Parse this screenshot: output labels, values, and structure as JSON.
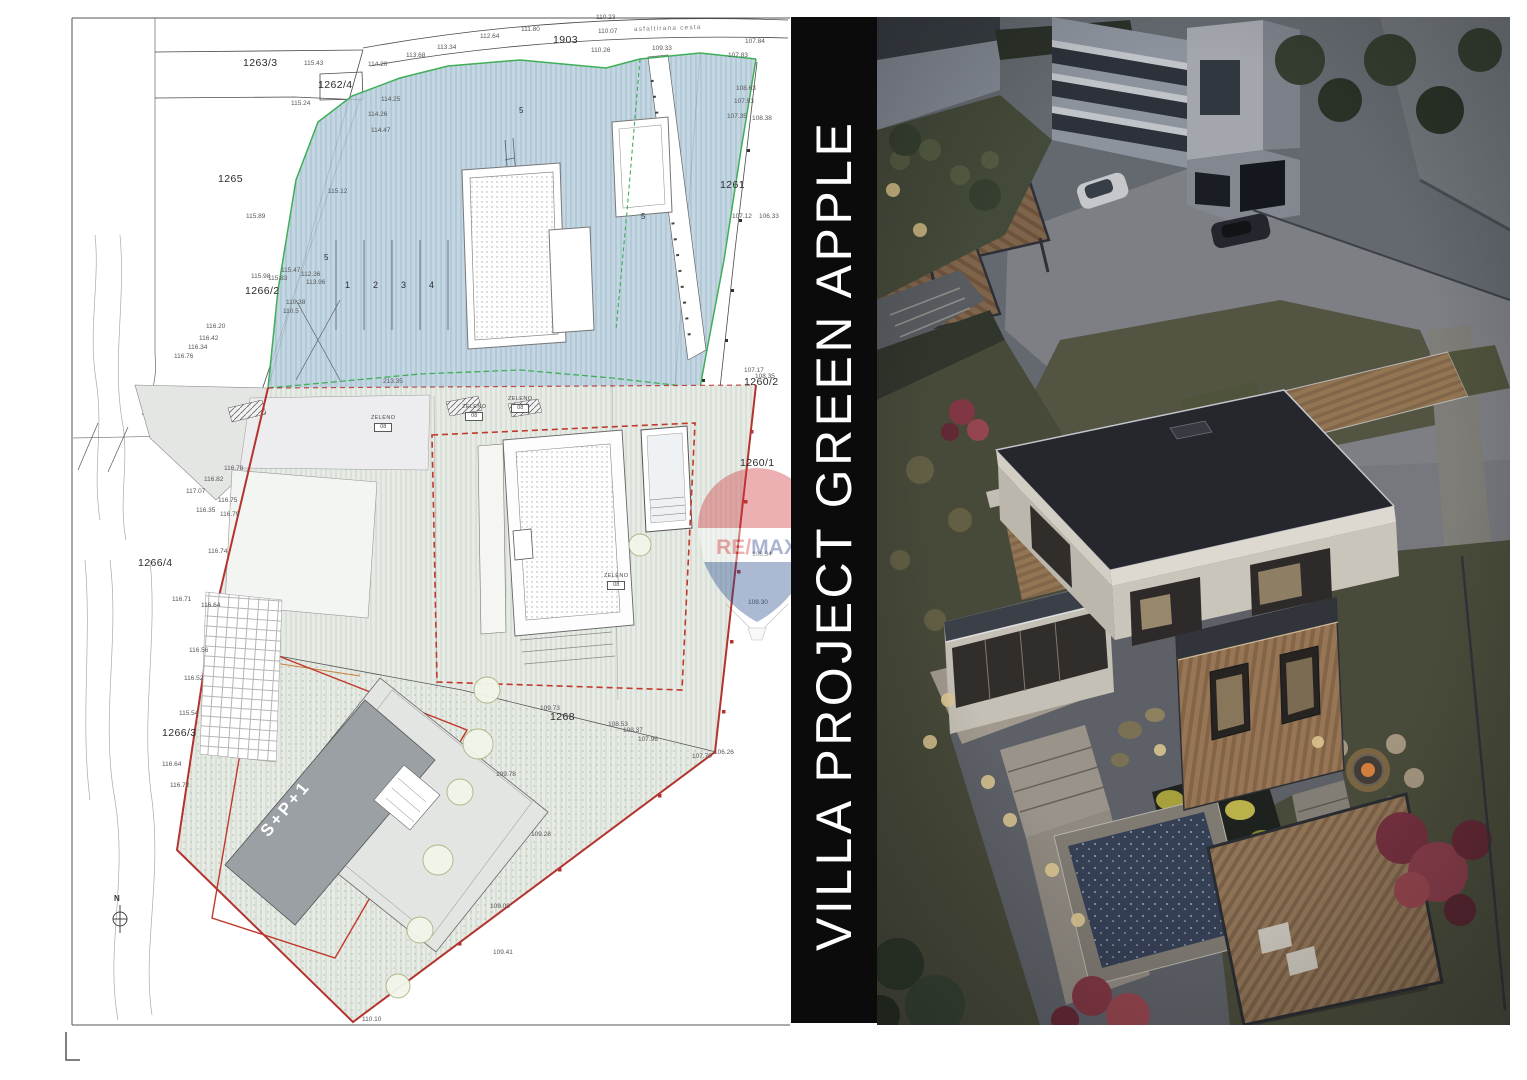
{
  "banner": {
    "text": "VILLA PROJECT GREEN APPLE",
    "bg": "#0b0b0b",
    "fg": "#ffffff"
  },
  "watermark": {
    "re": "RE",
    "slash": "/",
    "max": "MAX",
    "red": "#d93238",
    "blue": "#243f85",
    "balloon_red": "#cf3339",
    "balloon_blue": "#274a8c"
  },
  "colors": {
    "plot_boundary_red": "#b4332e",
    "zone_green": "#3fae57",
    "blue_hatch": "#b9cfdd",
    "gray_hatch": "#e7ebe6",
    "photo_dusk": "#65696e"
  },
  "site_plan": {
    "north_label": "N",
    "texts": [
      {
        "t": "1263/3",
        "x": 243,
        "y": 58,
        "cls": "parcel"
      },
      {
        "t": "1262/4",
        "x": 318,
        "y": 80,
        "cls": "parcel"
      },
      {
        "t": "1265",
        "x": 218,
        "y": 174,
        "cls": "parcel"
      },
      {
        "t": "1266/2",
        "x": 245,
        "y": 286,
        "cls": "parcel"
      },
      {
        "t": "1266/4",
        "x": 138,
        "y": 558,
        "cls": "parcel"
      },
      {
        "t": "1266/3",
        "x": 162,
        "y": 728,
        "cls": "parcel"
      },
      {
        "t": "1903",
        "x": 553,
        "y": 35,
        "cls": "parcel"
      },
      {
        "t": "1261",
        "x": 720,
        "y": 180,
        "cls": "parcel"
      },
      {
        "t": "1260/2",
        "x": 744,
        "y": 377,
        "cls": "parcel"
      },
      {
        "t": "1260/1",
        "x": 740,
        "y": 458,
        "cls": "parcel"
      },
      {
        "t": "1268",
        "x": 550,
        "y": 712,
        "cls": "parcel"
      },
      {
        "t": "asfaltirana cesta",
        "x": 634,
        "y": 26,
        "cls": "road",
        "rot": -2
      },
      {
        "t": "S+P+1",
        "x": 252,
        "y": 800,
        "cls": "bldg",
        "rot": -50
      },
      {
        "t": "N",
        "x": 114,
        "y": 895,
        "cls": "north"
      },
      {
        "t": "1",
        "x": 345,
        "y": 281,
        "cls": "lane"
      },
      {
        "t": "2",
        "x": 373,
        "y": 281,
        "cls": "lane"
      },
      {
        "t": "3",
        "x": 401,
        "y": 281,
        "cls": "lane"
      },
      {
        "t": "4",
        "x": 429,
        "y": 281,
        "cls": "lane"
      },
      {
        "t": "5",
        "x": 324,
        "y": 254,
        "cls": "five"
      },
      {
        "t": "5",
        "x": 519,
        "y": 107,
        "cls": "five"
      },
      {
        "t": "5",
        "x": 641,
        "y": 213,
        "cls": "five"
      },
      {
        "t": "113.34",
        "x": 437,
        "y": 45
      },
      {
        "t": "112.64",
        "x": 480,
        "y": 34
      },
      {
        "t": "111.80",
        "x": 521,
        "y": 27
      },
      {
        "t": "110.23",
        "x": 596,
        "y": 15
      },
      {
        "t": "110.07",
        "x": 598,
        "y": 29
      },
      {
        "t": "110.26",
        "x": 591,
        "y": 48
      },
      {
        "t": "109.33",
        "x": 652,
        "y": 46
      },
      {
        "t": "107.83",
        "x": 728,
        "y": 53
      },
      {
        "t": "107.84",
        "x": 745,
        "y": 39
      },
      {
        "t": "113.68",
        "x": 406,
        "y": 53
      },
      {
        "t": "115.43",
        "x": 304,
        "y": 61
      },
      {
        "t": "114.20",
        "x": 368,
        "y": 62
      },
      {
        "t": "115.24",
        "x": 291,
        "y": 101
      },
      {
        "t": "114.25",
        "x": 381,
        "y": 97
      },
      {
        "t": "114.26",
        "x": 368,
        "y": 112
      },
      {
        "t": "114.47",
        "x": 371,
        "y": 128
      },
      {
        "t": "115.12",
        "x": 328,
        "y": 189
      },
      {
        "t": "115.89",
        "x": 246,
        "y": 214
      },
      {
        "t": "108.63",
        "x": 736,
        "y": 86
      },
      {
        "t": "107.93",
        "x": 734,
        "y": 99
      },
      {
        "t": "107.35",
        "x": 727,
        "y": 114
      },
      {
        "t": "108.38",
        "x": 752,
        "y": 116
      },
      {
        "t": "107.12",
        "x": 732,
        "y": 214
      },
      {
        "t": "106.33",
        "x": 759,
        "y": 214
      },
      {
        "t": "107.17",
        "x": 744,
        "y": 368
      },
      {
        "t": "108.35",
        "x": 755,
        "y": 374
      },
      {
        "t": "108.34",
        "x": 752,
        "y": 552
      },
      {
        "t": "108.30",
        "x": 748,
        "y": 600
      },
      {
        "t": "116.20",
        "x": 206,
        "y": 324
      },
      {
        "t": "116.42",
        "x": 199,
        "y": 336
      },
      {
        "t": "116.34",
        "x": 188,
        "y": 345
      },
      {
        "t": "116.76",
        "x": 174,
        "y": 354
      },
      {
        "t": "115.98",
        "x": 251,
        "y": 274
      },
      {
        "t": "115.83",
        "x": 268,
        "y": 276
      },
      {
        "t": "115.47",
        "x": 281,
        "y": 268
      },
      {
        "t": "117.07",
        "x": 186,
        "y": 489
      },
      {
        "t": "116.82",
        "x": 204,
        "y": 477
      },
      {
        "t": "116.78",
        "x": 224,
        "y": 466
      },
      {
        "t": "116.75",
        "x": 218,
        "y": 498
      },
      {
        "t": "116.35",
        "x": 196,
        "y": 508
      },
      {
        "t": "116.79",
        "x": 220,
        "y": 512
      },
      {
        "t": "116.74",
        "x": 208,
        "y": 549
      },
      {
        "t": "116.71",
        "x": 172,
        "y": 597
      },
      {
        "t": "116.64",
        "x": 201,
        "y": 603
      },
      {
        "t": "116.56",
        "x": 189,
        "y": 648
      },
      {
        "t": "116.52",
        "x": 184,
        "y": 676
      },
      {
        "t": "115.54",
        "x": 179,
        "y": 711
      },
      {
        "t": "116.64",
        "x": 162,
        "y": 762
      },
      {
        "t": "116.72",
        "x": 170,
        "y": 783
      },
      {
        "t": "112.36",
        "x": 301,
        "y": 272
      },
      {
        "t": "113.96",
        "x": 306,
        "y": 280
      },
      {
        "t": "110.38",
        "x": 286,
        "y": 300
      },
      {
        "t": "110.5",
        "x": 283,
        "y": 309
      },
      {
        "t": "213.35",
        "x": 383,
        "y": 379
      },
      {
        "t": "109.73",
        "x": 540,
        "y": 706
      },
      {
        "t": "108.53",
        "x": 608,
        "y": 722
      },
      {
        "t": "108.37",
        "x": 623,
        "y": 728
      },
      {
        "t": "107.96",
        "x": 638,
        "y": 737
      },
      {
        "t": "107.70",
        "x": 692,
        "y": 754
      },
      {
        "t": "106.26",
        "x": 714,
        "y": 750
      },
      {
        "t": "109.78",
        "x": 496,
        "y": 772
      },
      {
        "t": "109.28",
        "x": 531,
        "y": 832
      },
      {
        "t": "109.08",
        "x": 490,
        "y": 904
      },
      {
        "t": "109.41",
        "x": 493,
        "y": 950
      },
      {
        "t": "110.10",
        "x": 362,
        "y": 1017
      }
    ],
    "zeleno": [
      {
        "label": "ZELENO",
        "code": "08",
        "x": 371,
        "y": 416
      },
      {
        "label": "ZELENO",
        "code": "08",
        "x": 462,
        "y": 405
      },
      {
        "label": "ZELENO",
        "code": "08",
        "x": 508,
        "y": 397
      },
      {
        "label": "ZELENO",
        "code": "08",
        "x": 604,
        "y": 574
      }
    ]
  }
}
